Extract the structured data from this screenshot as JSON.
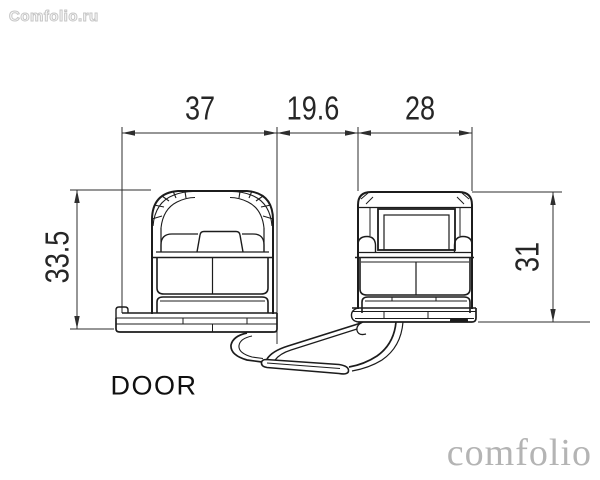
{
  "watermarks": {
    "top_left": "Comfolio.ru",
    "bottom_right": "comfolio"
  },
  "drawing": {
    "part_label": "DOOR",
    "dimensions": {
      "top": [
        "37",
        "19.6",
        "28"
      ],
      "left": "33.5",
      "right": "31"
    }
  },
  "colors": {
    "background": "#ffffff",
    "drawing_line": "#1c1c1c",
    "dimension_line": "#2e2e2e",
    "dimension_text": "#262626",
    "watermark_outline": "#c6c6c6",
    "watermark_serif": "#b4b4b4"
  }
}
